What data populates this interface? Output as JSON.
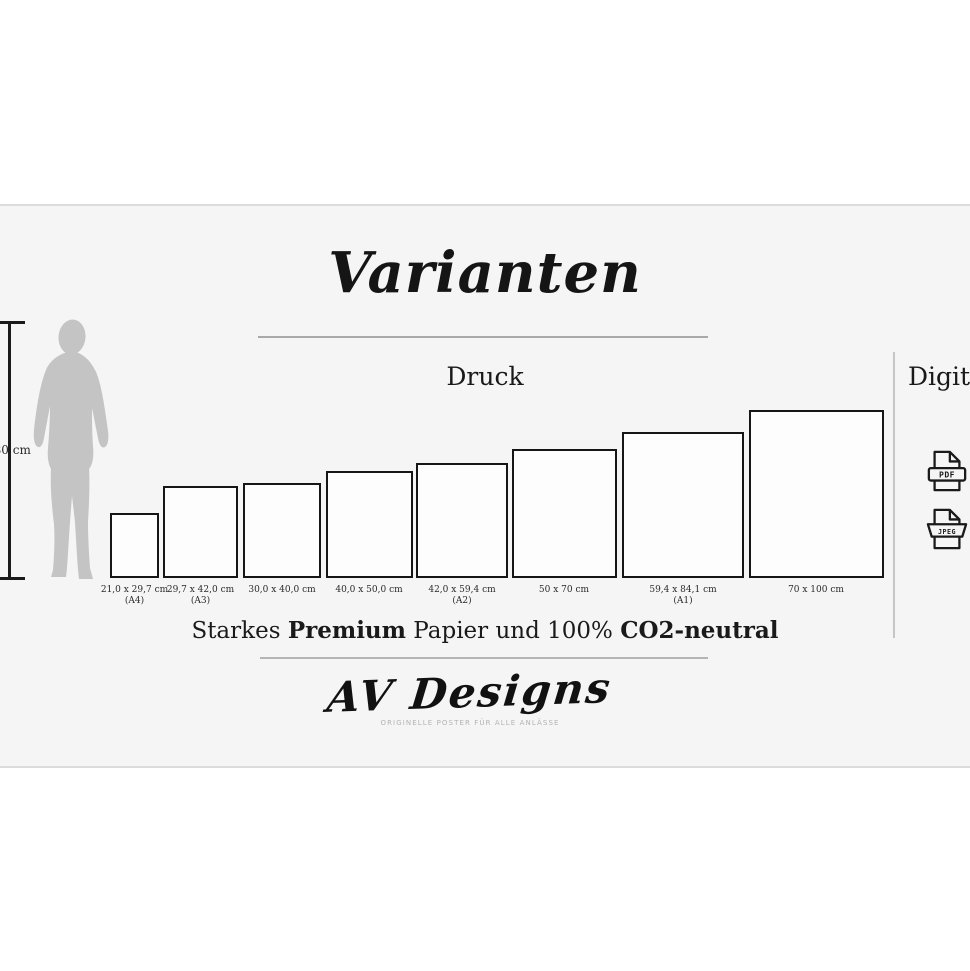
{
  "page": {
    "title": "Varianten"
  },
  "sections": {
    "print": {
      "label": "Druck"
    },
    "digital": {
      "label": "Digital",
      "files": [
        {
          "type": "PDF"
        },
        {
          "type": "JPEG"
        }
      ]
    }
  },
  "scale_reference": {
    "height_label": "180 cm"
  },
  "sizes": [
    {
      "dimensions": "21,0 x 29,7 cm",
      "format": "(A4)"
    },
    {
      "dimensions": "29,7 x 42,0 cm",
      "format": "(A3)"
    },
    {
      "dimensions": "30,0 x 40,0 cm",
      "format": ""
    },
    {
      "dimensions": "40,0 x 50,0 cm",
      "format": ""
    },
    {
      "dimensions": "42,0 x 59,4 cm",
      "format": "(A2)"
    },
    {
      "dimensions": "50 x 70 cm",
      "format": ""
    },
    {
      "dimensions": "59,4 x 84,1 cm",
      "format": "(A1)"
    },
    {
      "dimensions": "70 x 100 cm",
      "format": ""
    }
  ],
  "premium_line": {
    "part1": "Starkes ",
    "bold1": "Premium",
    "part2": " Papier und 100% ",
    "bold2": "CO2-neutral"
  },
  "brand": {
    "name": "AV Designs",
    "tagline": "ORIGINELLE POSTER FÜR ALLE ANLÄSSE"
  },
  "colors": {
    "panel_background": "#f5f5f6",
    "ink": "#1a1a1a",
    "silhouette": "#c4c4c4",
    "divider": "#dcdcdc"
  }
}
